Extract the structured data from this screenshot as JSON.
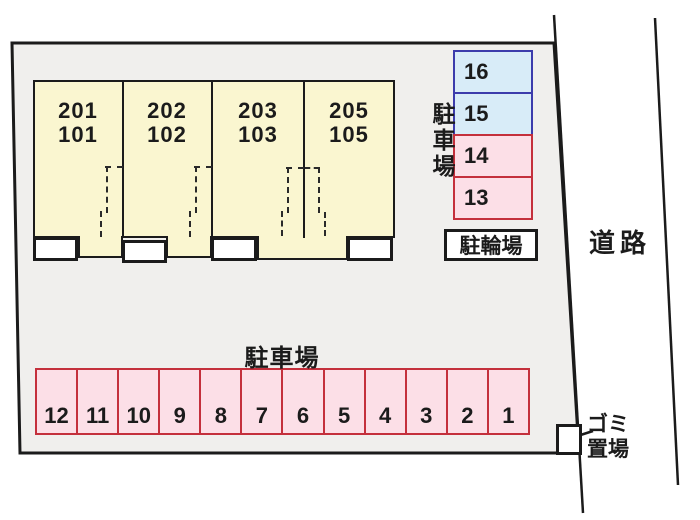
{
  "building": {
    "units": [
      {
        "upper": "201",
        "lower": "101"
      },
      {
        "upper": "202",
        "lower": "102"
      },
      {
        "upper": "203",
        "lower": "103"
      },
      {
        "upper": "205",
        "lower": "105"
      }
    ]
  },
  "side_parking": {
    "label": "駐車場",
    "spaces": [
      {
        "number": "16",
        "color": "blue"
      },
      {
        "number": "15",
        "color": "blue"
      },
      {
        "number": "14",
        "color": "pink"
      },
      {
        "number": "13",
        "color": "pink"
      }
    ]
  },
  "bicycle_parking": {
    "label": "駐輪場"
  },
  "bottom_parking": {
    "label": "駐車場",
    "spaces": [
      "12",
      "11",
      "10",
      "9",
      "8",
      "7",
      "6",
      "5",
      "4",
      "3",
      "2",
      "1"
    ]
  },
  "garbage_area": {
    "line1": "ゴミ",
    "line2": "置場"
  },
  "road": {
    "label": "道路"
  },
  "colors": {
    "site_fill": "#f0efed",
    "building_fill": "#faf6d0",
    "pink_fill": "#fcdfe7",
    "pink_border": "#c4303c",
    "blue_fill": "#d8ecf8",
    "blue_border": "#3c3cac",
    "outline": "#1b1b1b"
  }
}
